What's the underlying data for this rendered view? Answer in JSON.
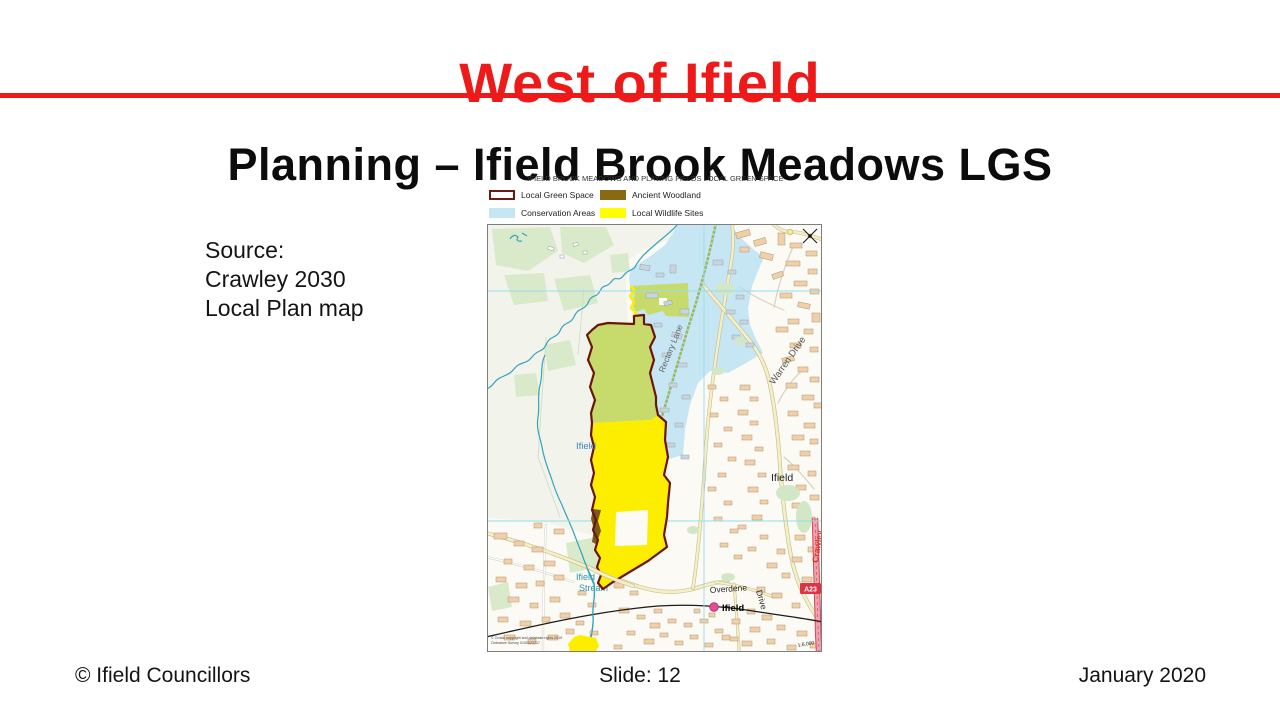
{
  "slide": {
    "title": "West of Ifield",
    "subtitle": "Planning – Ifield Brook Meadows LGS",
    "source_lines": [
      "Source:",
      "Crawley 2030",
      "Local Plan map"
    ],
    "footer": {
      "copyright": "© Ifield Councillors",
      "slide_number": "Slide: 12",
      "date": "January 2020"
    },
    "colors": {
      "accent_red": "#ee1a1a"
    }
  },
  "map": {
    "title": "IFIELD BROOK MEADOWS AND PLAYING FIELDS LOCAL GREEN SPACE",
    "legend": [
      {
        "label": "Local Green Space",
        "fill": "#ffffff",
        "border": "#6e1a10"
      },
      {
        "label": "Ancient Woodland",
        "fill": "#8a6914",
        "border": "#8a6914"
      },
      {
        "label": "Conservation Areas",
        "fill": "#c6e6f4",
        "border": "#c6e6f4"
      },
      {
        "label": "Local Wildlife Sites",
        "fill": "#ffff00",
        "border": "#ffff00"
      }
    ],
    "labels": {
      "rectory_lane": "Rectory Lane",
      "warren_drive": "Warren Drive",
      "ifield_west": "Ifield",
      "ifield_east": "Ifield",
      "ifield_station": "Ifield",
      "stream_line1": "Ifield",
      "stream_line2": "Stream",
      "overdene": "Overdene",
      "overdene_drive": "Drive",
      "crawley_avenue": "Crawley",
      "a23": "A23",
      "scale": "1:6,000",
      "copyright_line1": "© Crown copyright and database rights 2019",
      "copyright_line2": "Ordnance Survey 0100023717"
    },
    "colors": {
      "lgs_border": "#6b150c",
      "green_space": "#c7db6d",
      "wildlife_yellow": "#fdee00",
      "woodland_brown": "#7a5a1e",
      "conservation_blue": "#c6e6f4"
    }
  }
}
